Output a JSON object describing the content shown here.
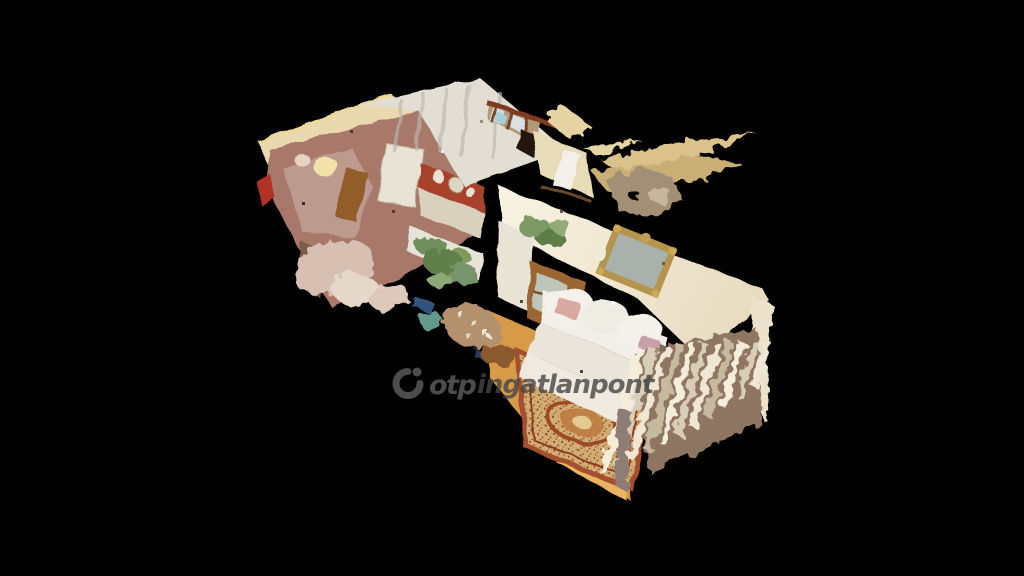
{
  "canvas": {
    "width": 1024,
    "height": 576,
    "background_color": "#000000"
  },
  "watermark": {
    "logo_icon": "otp-ring-logo",
    "brand": "otp",
    "name": "ingatlanpont",
    "color": "#4c4c4c"
  },
  "scene": {
    "kind": "3d-dollhouse-point-cloud-scan",
    "areas": [
      "kitchen",
      "hallway",
      "living-room"
    ],
    "palette": {
      "wall_cream": "#f3ead6",
      "wall_yellow_band": "#ead9ae",
      "wall_terracotta": "#a8432b",
      "ceiling_tan": "#dbc28b",
      "floor_wood": "#d79a49",
      "rug_rust": "#9c4a28",
      "rug_field": "#d0ae74",
      "sofa_white": "#f0ece3",
      "plant_green": "#6f8f5b",
      "mirror_gold": "#b5954e"
    }
  }
}
